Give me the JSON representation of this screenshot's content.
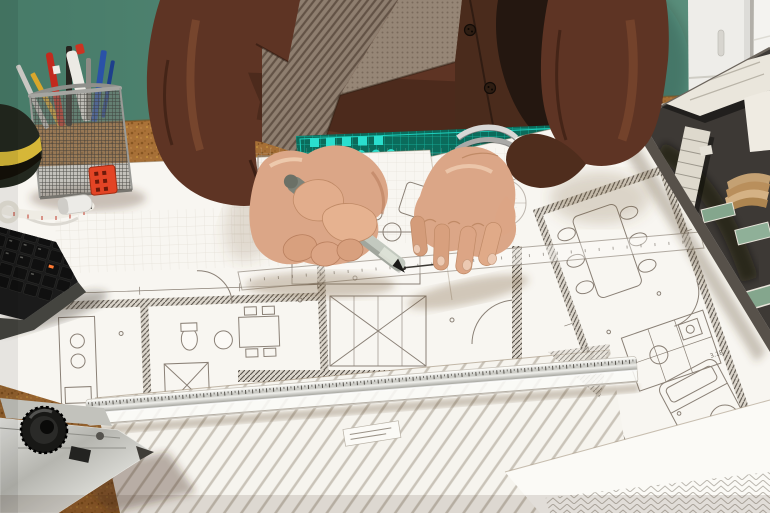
{
  "scene": {
    "type": "photograph",
    "subject": "Architect in brown shirt and knit vest drawing on architectural floor plans with a grey marker and transparent ruler",
    "setting": "cork-topped desk against a teal wall with white drawer cabinets and a dark site-model board"
  },
  "labels": {
    "dimension": "3.18"
  },
  "objects": [
    "teal wall",
    "white drawer cabinet",
    "white side cabinet",
    "office chair back",
    "cork desk surface",
    "wire mesh pen cup",
    "pens and pencils",
    "red clip",
    "black keyboard corner",
    "measuring tape",
    "marker cap",
    "black tool with yellow band",
    "architectural floor plan sheets",
    "green cutting mat",
    "grey marker",
    "transparent set square",
    "metal ruler",
    "adjustable drafting square",
    "architectural site model board",
    "cardboard model stack",
    "green model lawns",
    "silver bangle bracelets",
    "hands",
    "dark curly hair"
  ],
  "colors": {
    "wall": "#538b77",
    "cork": "#b0763a",
    "paper": "#f8f6f1",
    "planLine": "#8a8076",
    "planWall": "#57514a",
    "mat": "#0b6b5b",
    "matGrid": "#18bfa9",
    "matShape": "#2adfce",
    "shirt": "#5e3424",
    "vest": "#8e7e6f",
    "placket": "#4a2b1c",
    "hair": "#241710",
    "skin": "#dba687",
    "skinShadow": "#b97f5e",
    "nail": "#ecc9b2",
    "board": "#3d3935",
    "modelWhite": "#eae6dc",
    "modelGreen": "#84a68d",
    "cardboard": "#c4a173",
    "keyboard": "#1b1b1b",
    "marker": "#c3c9bf",
    "silver": "#c9c9c4",
    "bracelet": "#d2d2d0",
    "redClip": "#e34425",
    "yellowBand": "#d6b738",
    "tape": "#efece4",
    "cabinet": "#eeede9"
  }
}
